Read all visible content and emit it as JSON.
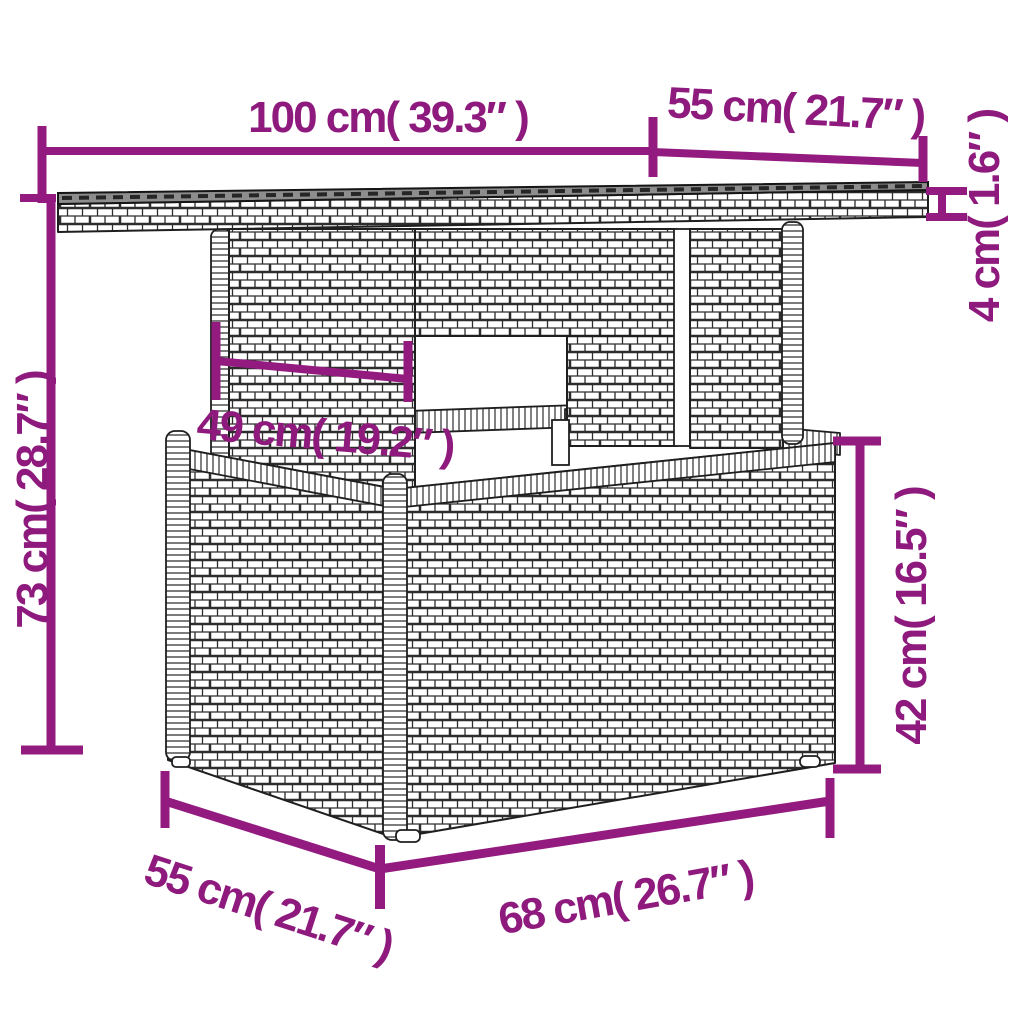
{
  "diagram": {
    "type": "product-dimensions",
    "subject": "wicker garden table with storage base",
    "accent_color": "#931b80",
    "label_color": "#8e1a7e",
    "outline_color": "#1f1f1f",
    "glass_top_color": "#8d8d8d",
    "background_color": "#ffffff",
    "measurements": {
      "top_width": "100 cm( 39.3″ )",
      "top_depth": "55 cm( 21.7″ )",
      "top_thickness": "4 cm( 1.6″ )",
      "total_height": "73 cm( 28.7″ )",
      "column_width": "49 cm( 19.2″ )",
      "base_height": "42 cm( 16.5″ )",
      "base_depth": "55 cm( 21.7″ )",
      "base_width": "68 cm( 26.7″ )"
    }
  }
}
